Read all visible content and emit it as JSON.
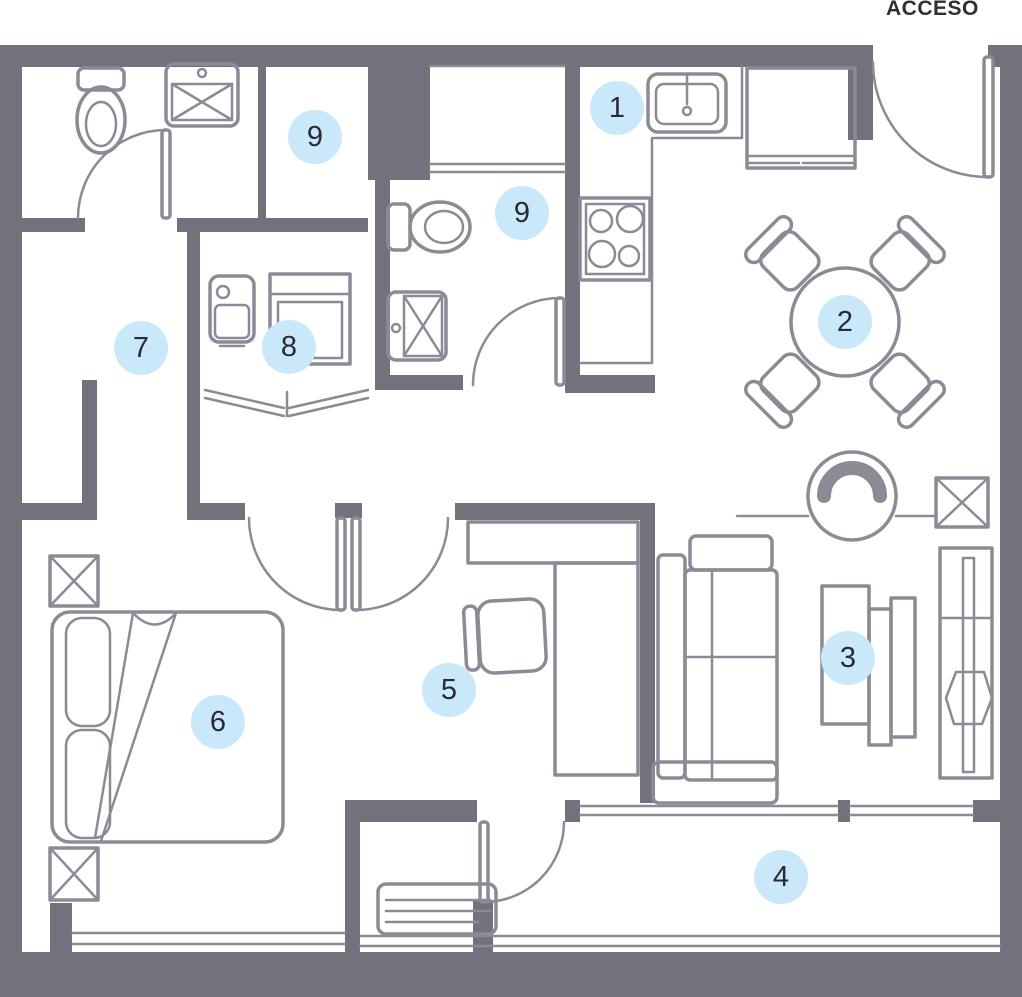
{
  "access_label": "ACCESO",
  "colors": {
    "background": "#FFFFFF",
    "wall": "#72727D",
    "furniture_line": "#8B8B96",
    "marker_fill": "#C9E9FB",
    "marker_text": "#2A2A33",
    "label_text": "#2F2F36"
  },
  "markers": [
    {
      "label": "1",
      "x": 617,
      "y": 108
    },
    {
      "label": "2",
      "x": 845,
      "y": 322
    },
    {
      "label": "3",
      "x": 848,
      "y": 658
    },
    {
      "label": "4",
      "x": 781,
      "y": 877
    },
    {
      "label": "5",
      "x": 449,
      "y": 690
    },
    {
      "label": "6",
      "x": 218,
      "y": 722
    },
    {
      "label": "7",
      "x": 141,
      "y": 348
    },
    {
      "label": "8",
      "x": 289,
      "y": 347
    },
    {
      "label": "9",
      "x": 315,
      "y": 137
    },
    {
      "label": "9",
      "x": 522,
      "y": 213
    }
  ]
}
